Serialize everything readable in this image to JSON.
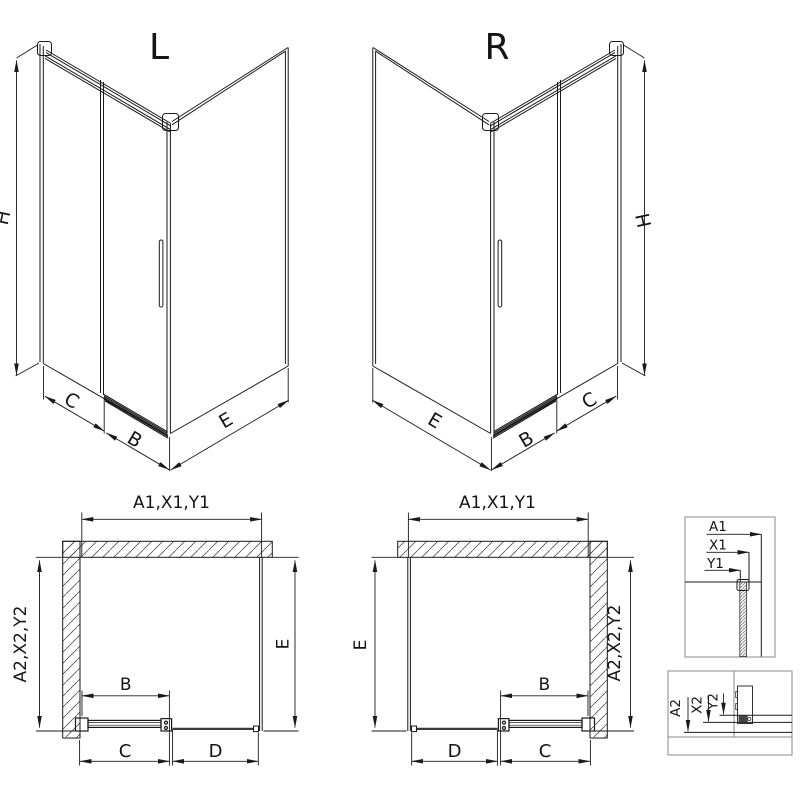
{
  "drawing": {
    "iso_left": {
      "title": "L",
      "dim_height": "H",
      "dim_c": "C",
      "dim_b": "B",
      "dim_e": "E"
    },
    "iso_right": {
      "title": "R",
      "dim_height": "H",
      "dim_c": "C",
      "dim_b": "B",
      "dim_e": "E"
    },
    "plan_left": {
      "dim_top": "A1,X1,Y1",
      "dim_left": "A2,X2,Y2",
      "dim_right": "E",
      "dim_b": "B",
      "dim_c": "C",
      "dim_d": "D"
    },
    "plan_right": {
      "dim_top": "A1,X1,Y1",
      "dim_left": "E",
      "dim_right": "A2,X2,Y2",
      "dim_b": "B",
      "dim_c": "C",
      "dim_d": "D"
    },
    "detail_top": {
      "rows": [
        "A1",
        "X1",
        "Y1"
      ]
    },
    "detail_bottom": {
      "rows": [
        "A2",
        "X2",
        "Y2"
      ]
    }
  }
}
